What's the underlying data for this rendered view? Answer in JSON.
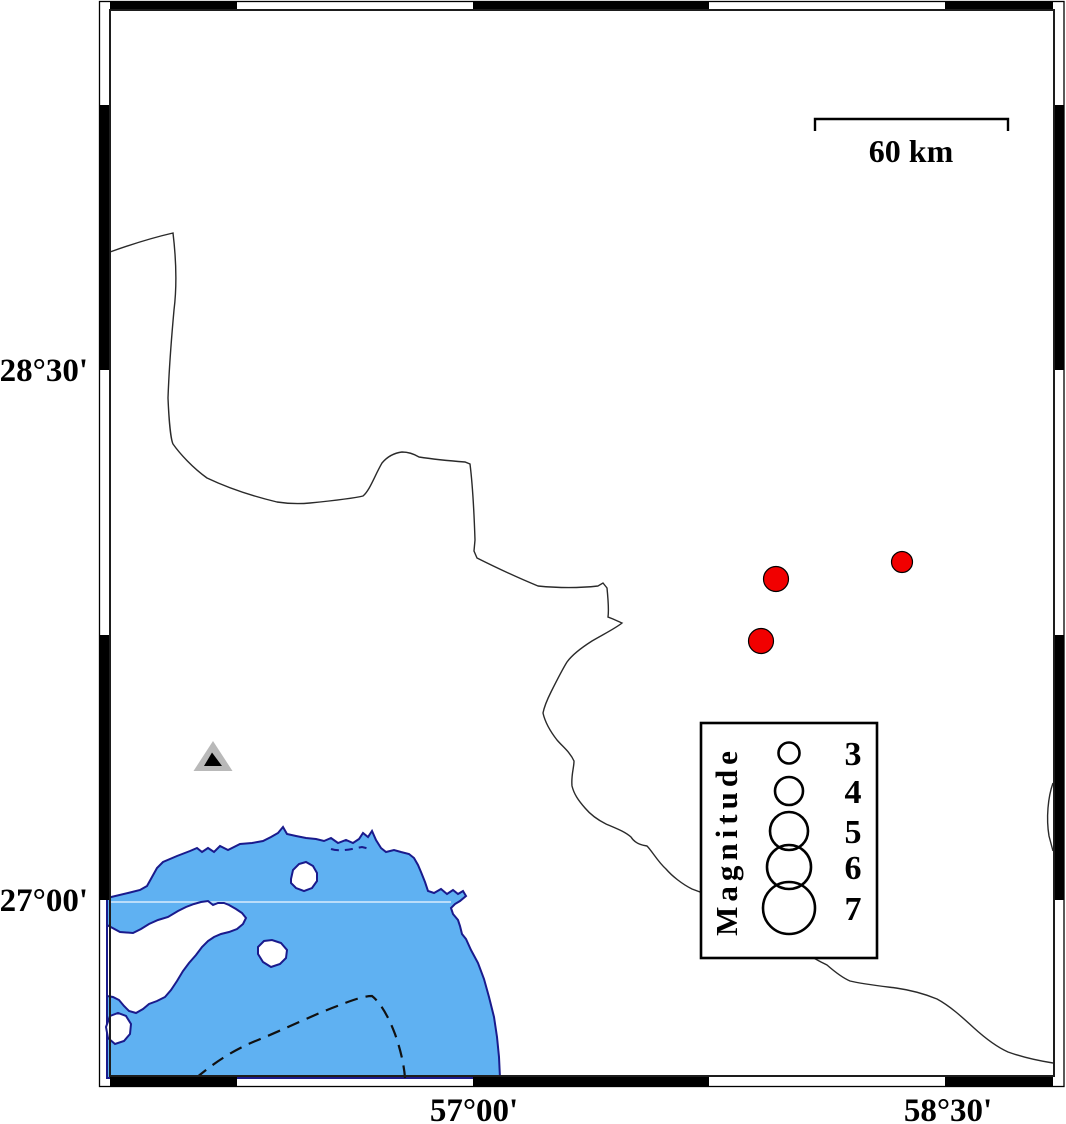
{
  "frame": {
    "lat_labels": [
      {
        "text": "28°30'"
      },
      {
        "text": "27°00'"
      }
    ],
    "lon_labels": [
      {
        "text": "57°00'"
      },
      {
        "text": "58°30'"
      }
    ]
  },
  "scale_bar": {
    "label": "60 km",
    "length_km": 60
  },
  "legend": {
    "title": "Magnitude",
    "entries": [
      {
        "label": "3",
        "r": 10.5
      },
      {
        "label": "4",
        "r": 14
      },
      {
        "label": "5",
        "r": 19
      },
      {
        "label": "6",
        "r": 22
      },
      {
        "label": "7",
        "r": 26
      }
    ]
  },
  "earthquakes": [
    {
      "x": 776,
      "y": 579,
      "r": 12.5
    },
    {
      "x": 902,
      "y": 562,
      "r": 10.5
    },
    {
      "x": 761,
      "y": 641,
      "r": 12.5
    }
  ],
  "station": {
    "x": 213,
    "y": 758
  },
  "colors": {
    "water": "#5fb1f2",
    "coast": "#1a1a8c",
    "quake": "#f10000",
    "station-gray": "#b9b9b9",
    "contour": "#111111",
    "border-line": "#2a2a2a",
    "water-gridline": "#d9ecfd"
  }
}
